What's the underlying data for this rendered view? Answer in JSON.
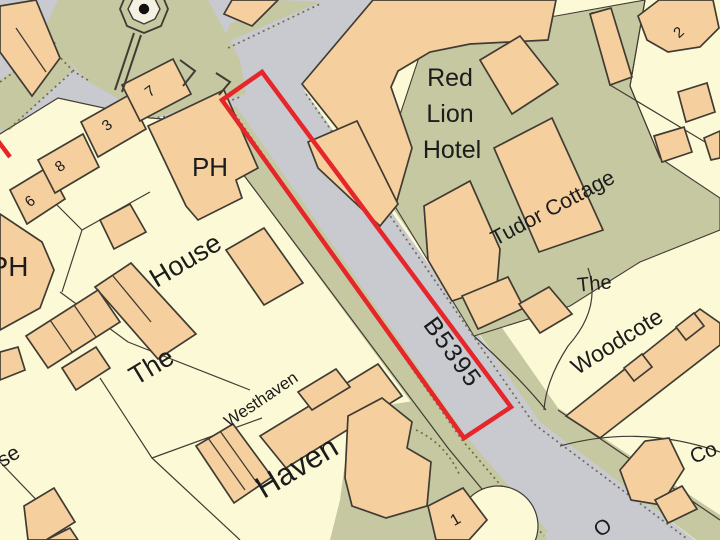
{
  "map": {
    "description_labels": {
      "red_lion_1": "Red",
      "red_lion_2": "Lion",
      "red_lion_3": "Hotel",
      "tudor": "Tudor Cottage",
      "the_right": "The",
      "woodcote": "Woodcote",
      "ph_upper": "PH",
      "ph_left": "PH",
      "house": "House",
      "the_left": "The",
      "westhaven": "Westhaven",
      "haven": "Haven",
      "road": "B5395",
      "n7": "7",
      "n3": "3",
      "n8": "8",
      "n6": "6",
      "n2": "2",
      "n1": "1",
      "se": "se",
      "co": "Co",
      "o": "O"
    }
  },
  "colors": {
    "road": "#c9c9d0",
    "verge": "#c5c8a1",
    "building": "#f6cf9f",
    "parcel": "#fcfad6",
    "outline": "#413c33",
    "dotted": "#6e6e4c",
    "highlight": "#e5262b",
    "text": "#1c1c1c",
    "monument_inner": "#f5f2e3"
  }
}
